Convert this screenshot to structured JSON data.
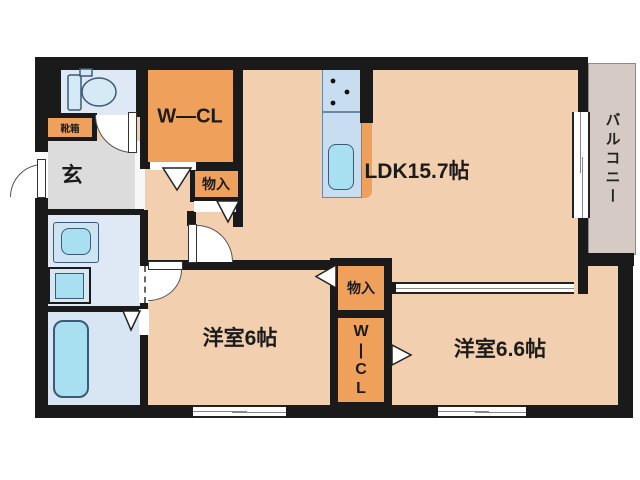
{
  "colors": {
    "wall": "#1a1a1a",
    "floor": "#f2cfae",
    "closet": "#efa05b",
    "water": "#dee9f5",
    "bath": "#d8e6f3",
    "fixture": "#a9e0f1",
    "genkan": "#dcdcdc",
    "balcony": "#d5cbc4",
    "counter": "#c9ddf0",
    "line": "#3b5a77"
  },
  "rooms": {
    "ldk": {
      "label": "LDK15.7帖"
    },
    "western1": {
      "label": "洋室6帖"
    },
    "western2": {
      "label": "洋室6.6帖"
    },
    "wcl": {
      "label": "W—CL"
    },
    "wicl": {
      "chars": [
        "W",
        "|",
        "C",
        "L"
      ]
    },
    "storage1": {
      "label": "物入"
    },
    "storage2": {
      "label": "物入"
    },
    "entrance": {
      "label": "玄"
    },
    "shoebox": {
      "label": "靴箱"
    },
    "balcony": {
      "label": "バルコニー"
    }
  }
}
